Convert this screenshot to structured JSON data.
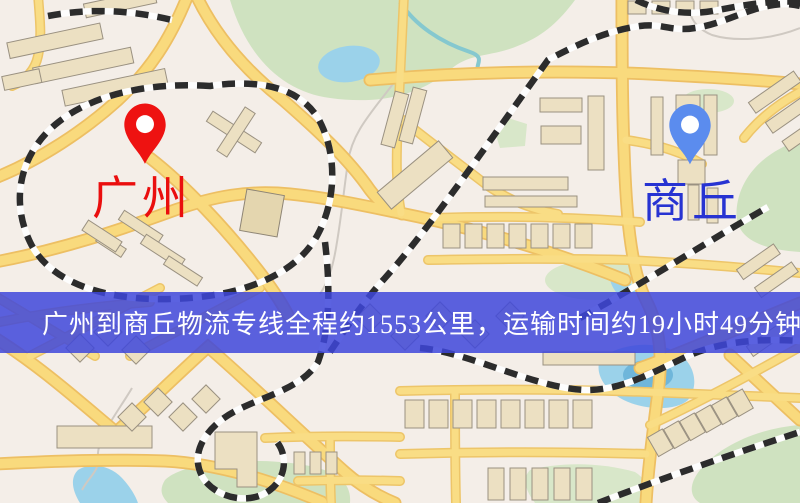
{
  "route": {
    "origin": {
      "name": "广州",
      "pin_color": "#ee1211",
      "label_color": "#ea0e0e"
    },
    "destination": {
      "name": "商丘",
      "pin_color": "#5b8cee",
      "label_color": "#2733d2"
    },
    "distance_km": "1553",
    "transit_time": "19小时49分钟"
  },
  "banner": {
    "text": "广州到商丘物流专线全程约1553公里，运输时间约19小时49分钟.",
    "overlay_color": "#3e46da",
    "text_color": "#ffffff"
  },
  "icons": {
    "origin_pin": "map-pin-icon",
    "destination_pin": "map-pin-icon"
  }
}
